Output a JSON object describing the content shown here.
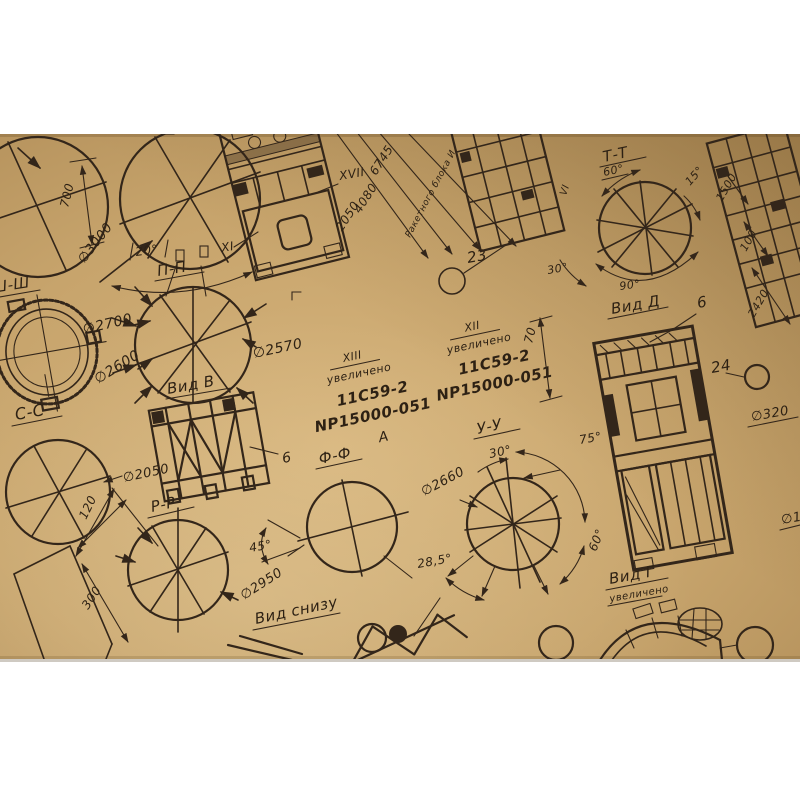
{
  "labels": {
    "sh_sh": "Ш-Ш",
    "p_p": "П-П",
    "c_c": "С-С",
    "t_t": "Т-Т",
    "r_r": "Р-Р",
    "f_f": "Ф-Ф",
    "u_u": "У-У",
    "vid_v": "Вид В",
    "vid_d": "Вид Д",
    "vid_g": "Вид Г",
    "vid_snizu": "Вид снизу",
    "uvelicheno": "увеличено",
    "xii": "XII",
    "xiii": "XIII",
    "code_line1": "11С59-2",
    "code_line2": "NP15000-051",
    "letter_a": "А",
    "xvii": "XVII",
    "xi": "XI",
    "vi": "VI",
    "rocket_block": "Ракетного блока И"
  },
  "diameters": {
    "d3000": "∅3000",
    "d2700": "∅2700",
    "d2600": "∅2600",
    "d2570": "∅2570",
    "d2050": "∅2050",
    "d2950": "∅2950",
    "d2660": "∅2660",
    "d320": "∅320",
    "d_partial": "∅1"
  },
  "dimensions": {
    "n700": "700",
    "n120": "120",
    "n300": "300",
    "n2050": "2050",
    "n4080": "4080",
    "n6745": "6745",
    "n70": "70",
    "n1500": "1500",
    "n100": "100",
    "n2420": "2420"
  },
  "angles": {
    "a20": "20°",
    "a30": "30°",
    "a45": "45°",
    "a60": "60°",
    "a75": "75°",
    "a90": "90°",
    "a15": "15°",
    "a28_5": "28,5°"
  },
  "callouts": {
    "c6": "6",
    "c23": "23",
    "c24": "24"
  },
  "colors": {
    "paper": "#c7a46c",
    "ink": "#33261a",
    "background": "#ffffff"
  }
}
